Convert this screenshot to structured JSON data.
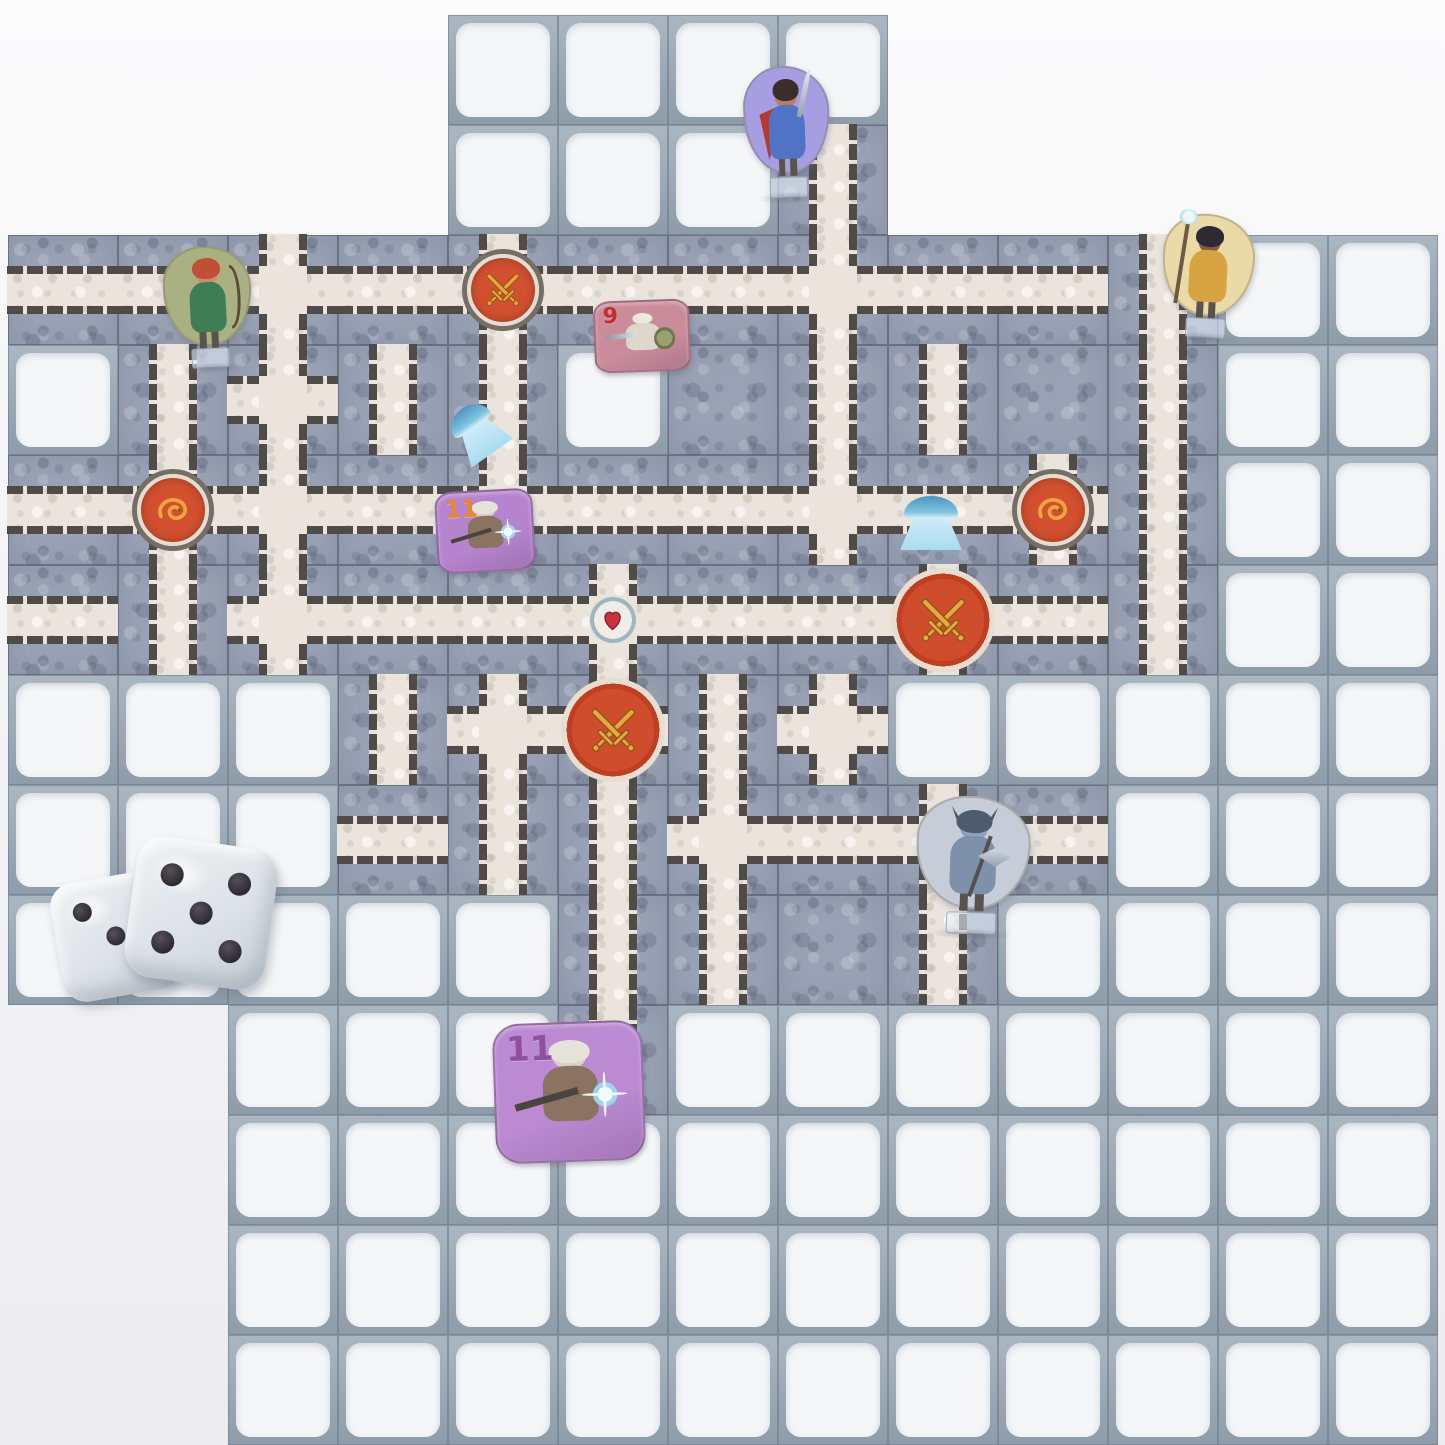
{
  "palette": {
    "bg": "#f3f3f5",
    "frame": "#8e9caa",
    "frameLight": "#aab7c2",
    "cellWhite": "#f4f6f8",
    "tile": "#99a1b4",
    "stone": "#eae4dd",
    "brick": "#4f4b48",
    "arenaRed": "#cd4b2e",
    "emblemGold": "#eda53f",
    "heartRed": "#cf3040",
    "water": "#bfe2f2"
  },
  "board": {
    "grid": {
      "cols": 13,
      "rows": 13,
      "cell_px": 110,
      "origin_x": 8,
      "origin_y": 15
    },
    "legend": {
      "F": "frame-empty-cell",
      "H": "tile-corridor-horizontal",
      "V": "tile-corridor-vertical",
      "C": "tile-corridor-cross",
      "P": "tile-plain",
      "S": "tile-swords-node",
      "D": "tile-dragon-node",
      "E": "tile-heart-node",
      "A": "tile-battle-arena"
    },
    "map": [
      "....FFFF.....",
      "....FFFV.....",
      "HHCHSHHCHHVFF",
      "FVCVVFPVVPVFF",
      "HDCHCHHCHDVFF",
      "HVCHHEHHAHVFF",
      "FFFVCAVCFFFFF",
      "FFFHVVCHCHFFF",
      "FFFFFVVPVFFFF",
      "..FFFVFFFFFFF",
      "..FFFFFFFFFFF",
      "..FFFFFFFFFFF",
      "..FFFFFFFFFFF"
    ]
  },
  "pieces": [
    {
      "kind": "standee",
      "name": "hero-warrior-standee",
      "x": 744,
      "y": 66,
      "w": 86,
      "h": 132,
      "rot": -2,
      "bg": "#a79ee2",
      "hair": "#3a2e2a",
      "skin": "#b97f5e",
      "outfit": "#5173c5",
      "accent": "#b23a33",
      "weapon": "sword"
    },
    {
      "kind": "standee",
      "name": "hero-ranger-standee",
      "x": 164,
      "y": 246,
      "w": 88,
      "h": 122,
      "rot": -3,
      "bg": "#a9b183",
      "hair": "#c24e35",
      "skin": "#c89070",
      "outfit": "#3f7d54",
      "accent": "#2e5b3e",
      "weapon": "bow"
    },
    {
      "kind": "standee",
      "name": "hero-mage-standee",
      "x": 1162,
      "y": 214,
      "w": 92,
      "h": 124,
      "rot": 3,
      "bg": "#e9daa7",
      "hair": "#2e2a33",
      "skin": "#8a5a3c",
      "outfit": "#d8a441",
      "accent": "#7ec8ea",
      "weapon": "staff"
    },
    {
      "kind": "standee",
      "name": "monster-knight-standee",
      "x": 916,
      "y": 796,
      "w": 114,
      "h": 138,
      "rot": 2,
      "bg": "#c6cdd8",
      "hair": "#4e5a6e",
      "skin": "#8fa0b8",
      "outfit": "#7e90aa",
      "accent": "#55617a",
      "weapon": "axe"
    },
    {
      "kind": "token",
      "name": "monster-token-skeleton",
      "number": "9",
      "x": 594,
      "y": 300,
      "w": 96,
      "h": 72,
      "rot": -2,
      "bg": "#ca8c9a",
      "num_color": "#c03028",
      "num_px": 22,
      "variant": "skeleton"
    },
    {
      "kind": "token",
      "name": "monster-token-ghoul",
      "number": "11",
      "x": 436,
      "y": 490,
      "w": 98,
      "h": 82,
      "rot": -3,
      "bg": "#b684ce",
      "num_color": "#e8862a",
      "num_px": 24,
      "variant": "ghoul"
    },
    {
      "kind": "token",
      "name": "monster-token-ghoul",
      "number": "11",
      "x": 494,
      "y": 1022,
      "w": 150,
      "h": 140,
      "rot": -2,
      "bg": "#bb8ad2",
      "num_color": "#8d4f9e",
      "num_px": 34,
      "variant": "ghoul"
    },
    {
      "kind": "die",
      "name": "die-showing-three",
      "value": 3,
      "x": 56,
      "y": 876,
      "size": 120,
      "rot": -10
    },
    {
      "kind": "die",
      "name": "die-showing-five",
      "value": 5,
      "x": 130,
      "y": 842,
      "size": 142,
      "rot": 8
    },
    {
      "kind": "fountain",
      "name": "water-fountain",
      "x": 896,
      "y": 496,
      "w": 70,
      "h": 54,
      "rot": 0
    },
    {
      "kind": "fountain",
      "name": "water-fountain",
      "x": 448,
      "y": 404,
      "w": 58,
      "h": 54,
      "rot": -35
    }
  ],
  "dice_pip_layouts": {
    "1": [
      [
        50,
        50
      ]
    ],
    "3": [
      [
        26,
        26
      ],
      [
        50,
        50
      ],
      [
        74,
        74
      ]
    ],
    "5": [
      [
        26,
        26
      ],
      [
        74,
        26
      ],
      [
        50,
        50
      ],
      [
        26,
        74
      ],
      [
        74,
        74
      ]
    ]
  }
}
